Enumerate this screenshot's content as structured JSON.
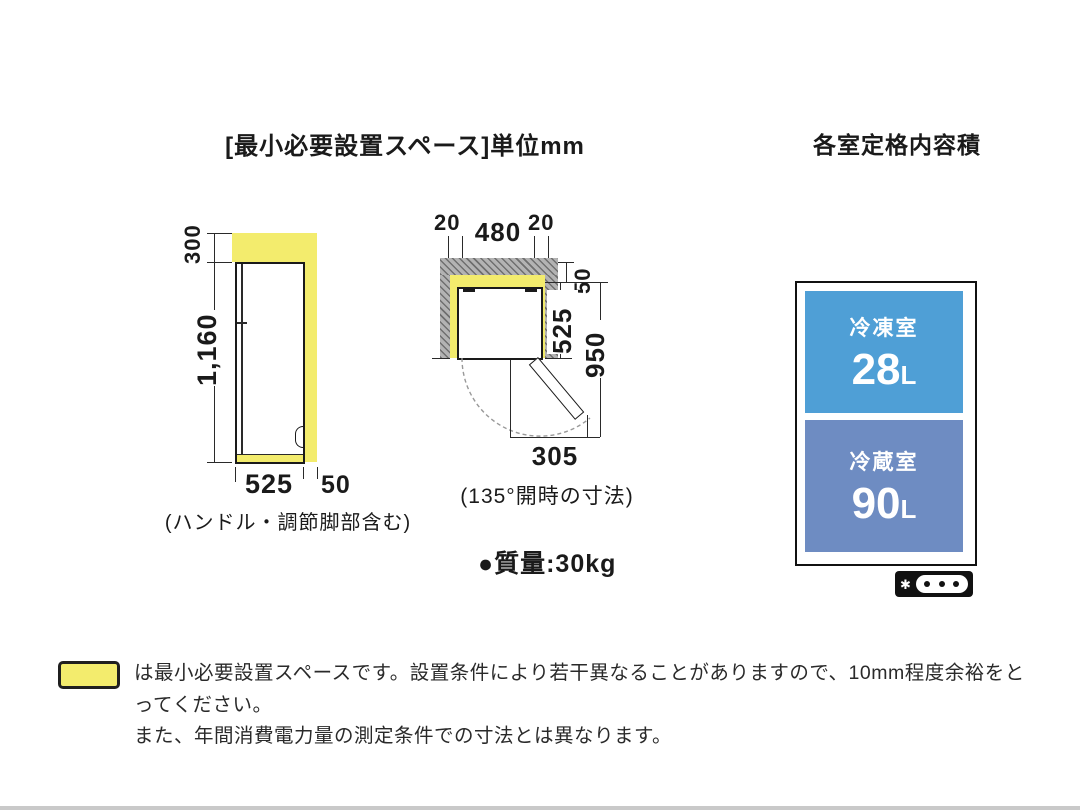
{
  "titles": {
    "main": "[最小必要設置スペース]単位mm",
    "right": "各室定格内容積"
  },
  "side_view": {
    "dim_above": "300",
    "dim_height": "1,160",
    "dim_depth": "525",
    "dim_rear": "50",
    "caption": "(ハンドル・調節脚部含む)"
  },
  "top_view": {
    "dim_side_left": "20",
    "dim_width": "480",
    "dim_side_right": "20",
    "dim_rear": "50",
    "dim_depth": "525",
    "dim_depth_open": "950",
    "dim_door": "305",
    "caption": "(135°開時の寸法)"
  },
  "weight": "●質量:30kg",
  "capacity": {
    "freezer": {
      "label": "冷凍室",
      "value": "28",
      "unit": "L"
    },
    "refrigerator": {
      "label": "冷蔵室",
      "value": "90",
      "unit": "L"
    }
  },
  "indicator": {
    "icon": "✱",
    "dots": 3
  },
  "legend": {
    "line1": "は最小必要設置スペースです。設置条件により若干異なることがありますので、10mm程度余裕をとってください。",
    "line2": "また、年間消費電力量の測定条件での寸法とは異なります。"
  },
  "colors": {
    "highlight_yellow": "#f3ec6d",
    "wall_gray": "#b3b3b3",
    "freezer_blue": "#4f9fd6",
    "refrigerator_blue": "#6e8cc2",
    "line": "#1a1a1a",
    "footer_bar": "#c9c9c9"
  }
}
